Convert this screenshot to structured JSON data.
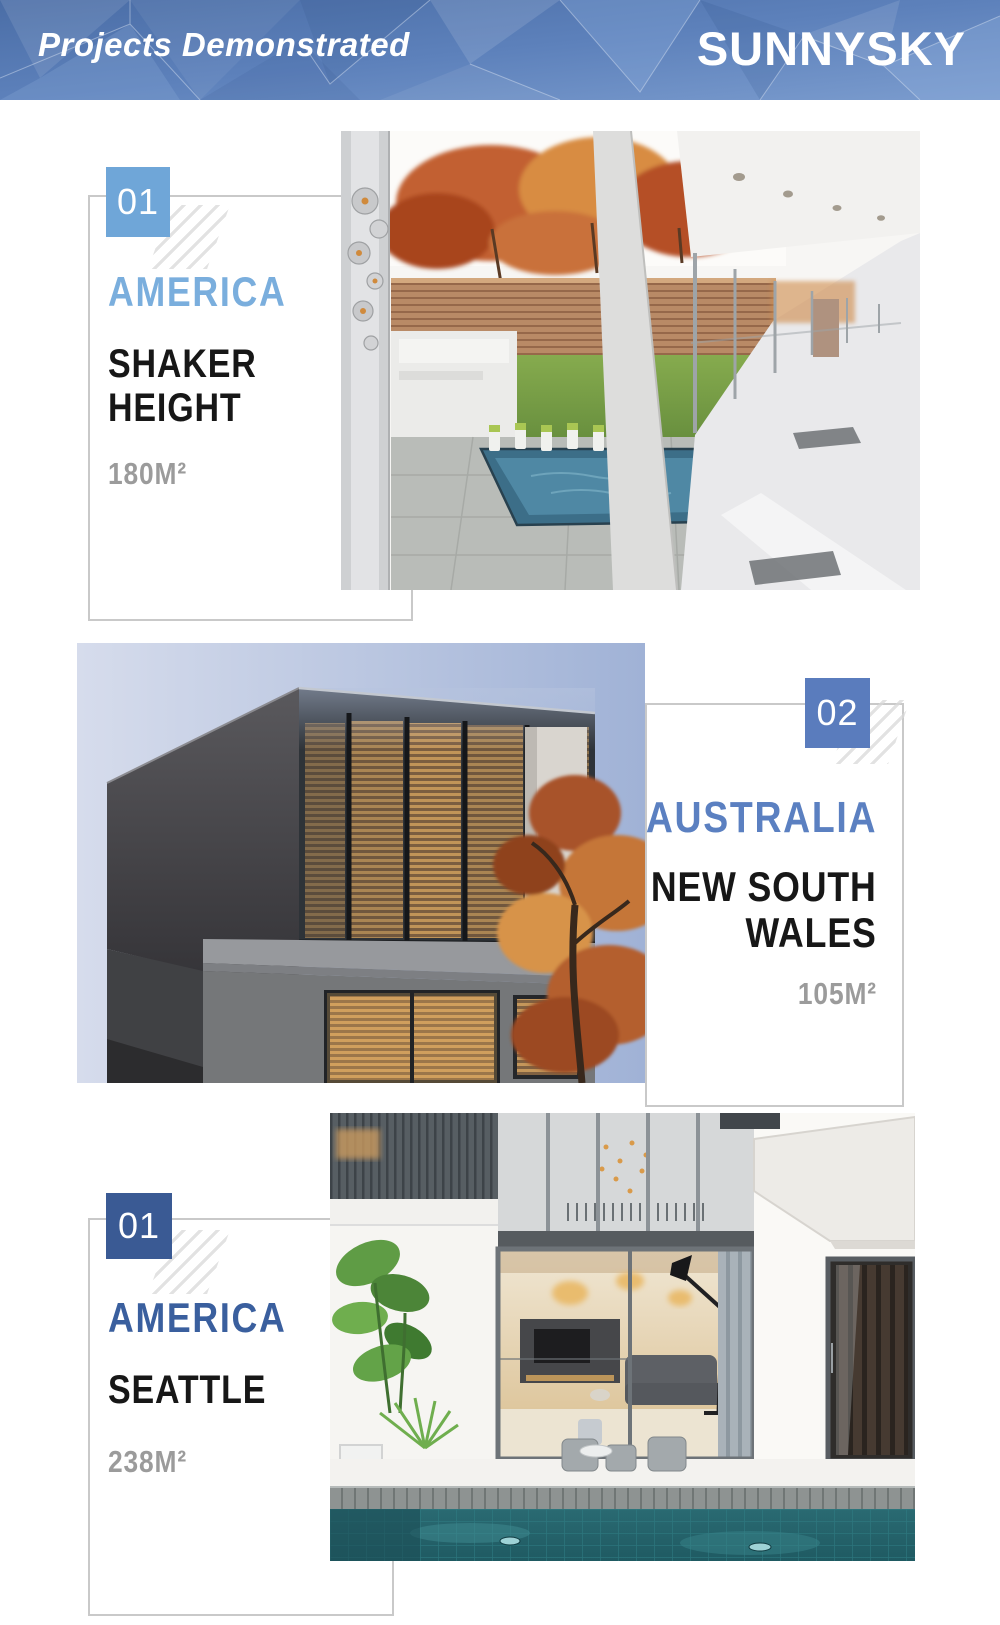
{
  "header": {
    "title": "Projects Demonstrated",
    "brand": "SUNNYSKY",
    "background_color": "#5b7fba",
    "text_color": "#ffffff"
  },
  "palette": {
    "frame_border": "#c9c9c9",
    "project_name_color": "#171717",
    "area_color": "#9b9b9b",
    "hatch_color": "#d8d8d8"
  },
  "projects": [
    {
      "number": "01",
      "country": "AMERICA",
      "country_color": "#7aaedd",
      "badge_color": "#6fa6d8",
      "name_lines": [
        "SHAKER",
        "HEIGHT"
      ],
      "area": "180M²",
      "photo_alt": "Glass-walled modern house interior overlooking an autumn courtyard with pool"
    },
    {
      "number": "02",
      "country": "AUSTRALIA",
      "country_color": "#5b80c1",
      "badge_color": "#5a7cbd",
      "name_lines": [
        "NEW SOUTH",
        "WALES"
      ],
      "area": "105M²",
      "photo_alt": "Dark concrete house at dusk with amber lit window blinds and autumn tree"
    },
    {
      "number": "01",
      "country": "AMERICA",
      "country_color": "#3a5f9e",
      "badge_color": "#3a5a94",
      "name_lines": [
        "SEATTLE"
      ],
      "area": "238M²",
      "photo_alt": "Modern white villa courtyard with double-height glazing and mosaic pool"
    }
  ]
}
